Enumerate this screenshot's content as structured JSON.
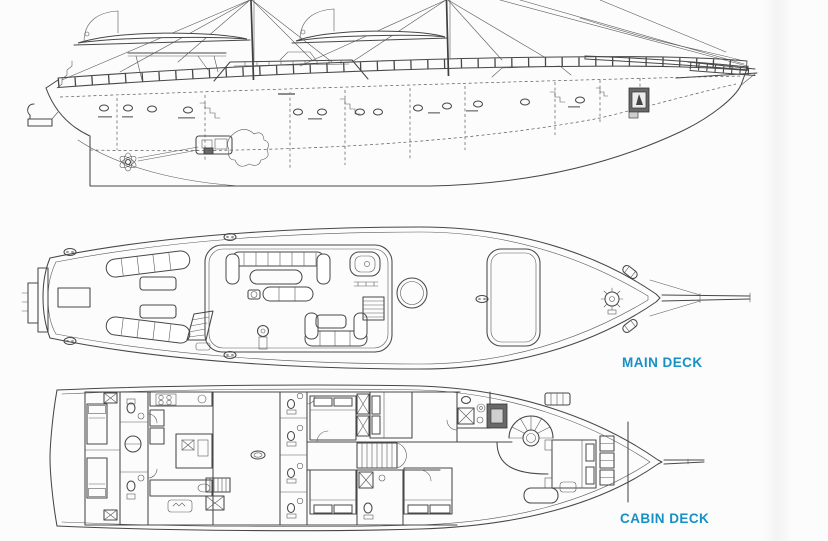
{
  "page": {
    "background_color": "#fcfcfc",
    "drawing_line_color": "#474747",
    "accent_color": "#1591c5"
  },
  "labels": {
    "main_deck": "MAIN DECK",
    "cabin_deck": "CABIN DECK"
  }
}
